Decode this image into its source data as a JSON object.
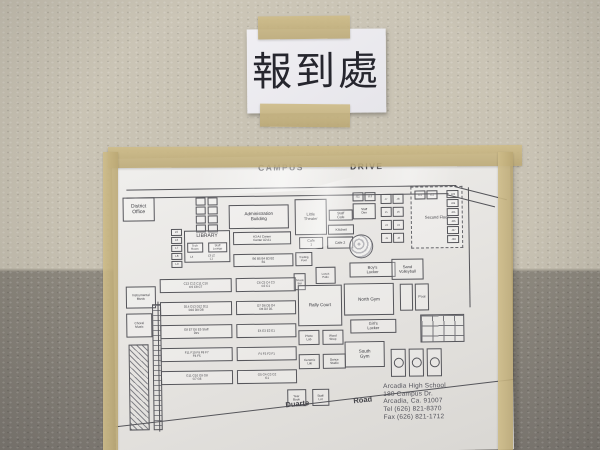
{
  "colors": {
    "wall_upper": "#c9c2b3",
    "wall_lower": "#86817a",
    "tape": "#c8b584",
    "sign_paper": "#ecebef",
    "map_paper": "#e7e5e2",
    "ink": "#3b3b40"
  },
  "sign": {
    "text": "報到處"
  },
  "map": {
    "school_info": [
      "Arcadia High School",
      "180 Campus Dr.",
      "Arcadia, Ca. 91007",
      "Tel (626) 821-8370",
      "Fax (626) 821-1712"
    ],
    "labels": [
      {
        "n": "street-label-campus",
        "t": "CAMPUS",
        "x": 146,
        "y": 6,
        "fs": 8.5,
        "ls": 1.5
      },
      {
        "n": "street-label-drive",
        "t": "DRIVE",
        "x": 238,
        "y": 6,
        "fs": 8.5,
        "ls": 1.5
      },
      {
        "n": "street-label-duarte",
        "t": "Duarte",
        "x": 170,
        "y": 243,
        "fs": 7.5,
        "deg": -5
      },
      {
        "n": "street-label-road",
        "t": "Road",
        "x": 238,
        "y": 240,
        "fs": 7.5,
        "deg": -5
      }
    ],
    "lines": [
      {
        "x": 14,
        "y": 31,
        "l": 330,
        "deg": 0
      },
      {
        "x": 14,
        "y": 39,
        "l": 322,
        "deg": 0
      },
      {
        "x": 342,
        "y": 32,
        "l": 54,
        "deg": 15
      },
      {
        "x": 334,
        "y": 40,
        "l": 50,
        "deg": 15
      },
      {
        "x": 356,
        "y": 33,
        "l": 120,
        "deg": 90
      },
      {
        "x": 44,
        "y": 143,
        "l": 130,
        "deg": 90
      },
      {
        "x": -4,
        "y": 268,
        "l": 416,
        "deg": -6
      }
    ],
    "buildings": [
      {
        "n": "district-office",
        "t": "District Office",
        "x": 10,
        "y": 39,
        "w": 32,
        "h": 24,
        "fs": 5
      },
      {
        "n": "portable-box",
        "t": "",
        "x": 83,
        "y": 40,
        "w": 10,
        "h": 8
      },
      {
        "n": "portable-box",
        "t": "",
        "x": 95,
        "y": 40,
        "w": 10,
        "h": 8
      },
      {
        "n": "portable-box",
        "t": "",
        "x": 83,
        "y": 49,
        "w": 10,
        "h": 8
      },
      {
        "n": "portable-box",
        "t": "",
        "x": 95,
        "y": 49,
        "w": 10,
        "h": 8
      },
      {
        "n": "portable-box",
        "t": "",
        "x": 83,
        "y": 58,
        "w": 10,
        "h": 8
      },
      {
        "n": "portable-box",
        "t": "",
        "x": 95,
        "y": 58,
        "w": 10,
        "h": 8
      },
      {
        "n": "portable-box",
        "t": "",
        "x": 83,
        "y": 67,
        "w": 10,
        "h": 8
      },
      {
        "n": "portable-box",
        "t": "",
        "x": 95,
        "y": 67,
        "w": 10,
        "h": 8
      },
      {
        "n": "administration-building",
        "t": "Administration Building",
        "x": 116,
        "y": 48,
        "w": 60,
        "h": 24,
        "fs": 4.5
      },
      {
        "n": "little-theater",
        "t": "Little Theater",
        "x": 182,
        "y": 43,
        "w": 32,
        "h": 36,
        "fs": 4
      },
      {
        "n": "staff-cafe",
        "t": "Staff Cafe",
        "x": 216,
        "y": 54,
        "w": 24,
        "h": 11,
        "fs": 3.5
      },
      {
        "n": "kitchen",
        "t": "Kitchen",
        "x": 215,
        "y": 69,
        "w": 26,
        "h": 10,
        "fs": 3.5
      },
      {
        "n": "cafe-1",
        "t": "Cafe 1",
        "x": 186,
        "y": 81,
        "w": 24,
        "h": 12,
        "fs": 3.5
      },
      {
        "n": "cafe-2",
        "t": "Cafe 2",
        "x": 214,
        "y": 81,
        "w": 26,
        "h": 12,
        "fs": 3.5
      },
      {
        "n": "library",
        "t": "LIBRARY",
        "x": 71,
        "y": 73,
        "w": 46,
        "h": 32,
        "fs": 5,
        "cls": "top"
      },
      {
        "n": "tech-room",
        "t": "Tech Room",
        "x": 74,
        "y": 85,
        "w": 16,
        "h": 10,
        "fs": 2.8
      },
      {
        "n": "staff-lounge",
        "t": "Staff Lounge",
        "x": 95,
        "y": 85,
        "w": 19,
        "h": 10,
        "fs": 2.8
      },
      {
        "n": "room-l4",
        "t": "L4",
        "x": 74,
        "y": 96,
        "w": 8,
        "h": 7,
        "fs": 2.8,
        "cls": "noborder"
      },
      {
        "n": "rooms-l3-l2-l1",
        "t": "L3  L2  L1",
        "x": 84,
        "y": 96,
        "w": 28,
        "h": 7,
        "fs": 2.8,
        "cls": "noborder"
      },
      {
        "n": "room-l5",
        "t": "L5",
        "x": 58,
        "y": 71,
        "w": 11,
        "h": 7,
        "fs": 2.8
      },
      {
        "n": "room-l6",
        "t": "L6",
        "x": 58,
        "y": 79,
        "w": 11,
        "h": 7,
        "fs": 2.8
      },
      {
        "n": "room-l7",
        "t": "L7",
        "x": 58,
        "y": 87,
        "w": 11,
        "h": 7,
        "fs": 2.8
      },
      {
        "n": "room-l8",
        "t": "L8",
        "x": 58,
        "y": 95,
        "w": 11,
        "h": 7,
        "fs": 2.8
      },
      {
        "n": "room-l9",
        "t": "L9",
        "x": 58,
        "y": 103,
        "w": 11,
        "h": 7,
        "fs": 2.8
      },
      {
        "n": "a-row",
        "t": "A3   A4   Career Center   A2   A1",
        "x": 120,
        "y": 75,
        "w": 58,
        "h": 13,
        "fs": 3
      },
      {
        "n": "b-row",
        "t": "B6  B5  B4  B3  B2  B1",
        "x": 120,
        "y": 97,
        "w": 60,
        "h": 13,
        "fs": 3
      },
      {
        "n": "trading-post",
        "t": "Trading Post",
        "x": 182,
        "y": 96,
        "w": 17,
        "h": 14,
        "fs": 2.8
      },
      {
        "n": "snack-bar",
        "t": "Snack Bar",
        "x": 180,
        "y": 117,
        "w": 12,
        "h": 17,
        "fs": 2.8
      },
      {
        "n": "lunch-patio",
        "t": "Lunch Patio",
        "x": 202,
        "y": 111,
        "w": 20,
        "h": 17,
        "fs": 2.8
      },
      {
        "n": "amphitheater",
        "t": "",
        "x": 236,
        "y": 79,
        "w": 24,
        "h": 24,
        "cls": "fan"
      },
      {
        "n": "c-row-west",
        "t": "C13 C12 C11 C10 C9 C8 C7",
        "x": 46,
        "y": 121,
        "w": 72,
        "h": 14,
        "fs": 3
      },
      {
        "n": "c-row-east",
        "t": "C6  C5  C4  C3  C2  C1",
        "x": 122,
        "y": 121,
        "w": 60,
        "h": 14,
        "fs": 3
      },
      {
        "n": "d-row-west",
        "t": "D14 D13 D12 D11 D10 D9 D8",
        "x": 46,
        "y": 144,
        "w": 72,
        "h": 14,
        "fs": 3
      },
      {
        "n": "d-row-east",
        "t": "D7  D6  D5  D4  D3  D2  D1",
        "x": 122,
        "y": 144,
        "w": 60,
        "h": 14,
        "fs": 3
      },
      {
        "n": "e-row-west",
        "t": "E8  E7  E6  E5  Staff Dev",
        "x": 46,
        "y": 167,
        "w": 72,
        "h": 14,
        "fs": 3
      },
      {
        "n": "e-row-east",
        "t": "E4   E3   E2   E1",
        "x": 122,
        "y": 167,
        "w": 60,
        "h": 14,
        "fs": 3
      },
      {
        "n": "f-row-west",
        "t": "F11 F10 F9 F8 F7 F6 F5",
        "x": 46,
        "y": 190,
        "w": 72,
        "h": 14,
        "fs": 3
      },
      {
        "n": "f-row-east",
        "t": "F4   F3   F2   F1",
        "x": 122,
        "y": 190,
        "w": 60,
        "h": 14,
        "fs": 3
      },
      {
        "n": "g-row-west",
        "t": "G11 G10 G9 G8 G7 G6",
        "x": 46,
        "y": 213,
        "w": 72,
        "h": 14,
        "fs": 3
      },
      {
        "n": "g-row-east",
        "t": "G5  G4  G3  G2  G1",
        "x": 122,
        "y": 213,
        "w": 60,
        "h": 14,
        "fs": 3
      },
      {
        "n": "instrumental-music",
        "t": "Instrumental Music",
        "x": 12,
        "y": 128,
        "w": 30,
        "h": 22,
        "fs": 3.2
      },
      {
        "n": "choral-music",
        "t": "Choral Music",
        "x": 12,
        "y": 155,
        "w": 26,
        "h": 24,
        "fs": 3.2
      },
      {
        "n": "parking-lot",
        "t": "",
        "x": 14,
        "y": 186,
        "w": 20,
        "h": 86,
        "cls": "hatch"
      },
      {
        "n": "parking-stalls",
        "t": "",
        "x": 38,
        "y": 146,
        "w": 9,
        "h": 126,
        "cls": "rows"
      },
      {
        "n": "year-book",
        "t": "Year Book",
        "x": 172,
        "y": 233,
        "w": 19,
        "h": 17,
        "fs": 3
      },
      {
        "n": "staff-lot",
        "t": "Staff Lot",
        "x": 197,
        "y": 233,
        "w": 17,
        "h": 17,
        "fs": 3
      },
      {
        "n": "boys-locker",
        "t": "Boy's Locker",
        "x": 236,
        "y": 107,
        "w": 46,
        "h": 15,
        "fs": 4
      },
      {
        "n": "sand-volleyball",
        "t": "Sand Volleyball",
        "x": 278,
        "y": 104,
        "w": 32,
        "h": 21,
        "fs": 4
      },
      {
        "n": "north-gym",
        "t": "North Gym",
        "x": 230,
        "y": 128,
        "w": 50,
        "h": 32,
        "fs": 4.5
      },
      {
        "n": "pool-west",
        "t": "",
        "x": 286,
        "y": 129,
        "w": 13,
        "h": 27
      },
      {
        "n": "pool",
        "t": "Pool",
        "x": 301,
        "y": 129,
        "w": 14,
        "h": 27,
        "fs": 3.5
      },
      {
        "n": "rally-court",
        "t": "Rally Court",
        "x": 184,
        "y": 129,
        "w": 44,
        "h": 41,
        "fs": 4.5
      },
      {
        "n": "girls-locker",
        "t": "Girl's Locker",
        "x": 236,
        "y": 164,
        "w": 46,
        "h": 14,
        "fs": 4
      },
      {
        "n": "photo-lab",
        "t": "Photo Lab",
        "x": 184,
        "y": 174,
        "w": 21,
        "h": 15,
        "fs": 3
      },
      {
        "n": "wood-shop",
        "t": "Wood Shop",
        "x": 208,
        "y": 174,
        "w": 21,
        "h": 15,
        "fs": 3
      },
      {
        "n": "south-gym",
        "t": "South Gym",
        "x": 230,
        "y": 186,
        "w": 40,
        "h": 26,
        "fs": 4.5
      },
      {
        "n": "ceramic-lab",
        "t": "Ceramic Lab",
        "x": 184,
        "y": 198,
        "w": 21,
        "h": 15,
        "fs": 3
      },
      {
        "n": "dance-studio",
        "t": "Dance Studio",
        "x": 208,
        "y": 198,
        "w": 23,
        "h": 15,
        "fs": 3
      },
      {
        "n": "tennis-courts",
        "t": "",
        "x": 306,
        "y": 160,
        "w": 44,
        "h": 28,
        "cls": "grid"
      },
      {
        "n": "basketball-court",
        "t": "",
        "x": 276,
        "y": 194,
        "w": 15,
        "h": 28,
        "cls": "court"
      },
      {
        "n": "basketball-court",
        "t": "",
        "x": 294,
        "y": 194,
        "w": 15,
        "h": 28,
        "cls": "court"
      },
      {
        "n": "basketball-court",
        "t": "",
        "x": 312,
        "y": 194,
        "w": 15,
        "h": 28,
        "cls": "court"
      },
      {
        "n": "second-floor-block",
        "t": "Second Floor",
        "x": 298,
        "y": 32,
        "w": 52,
        "h": 62,
        "fs": 4,
        "cls": "dashed"
      },
      {
        "n": "room-j21",
        "t": "J21",
        "x": 302,
        "y": 36,
        "w": 11,
        "h": 9,
        "fs": 2.6
      },
      {
        "n": "room-j22",
        "t": "J22",
        "x": 314,
        "y": 36,
        "w": 11,
        "h": 9,
        "fs": 2.6
      },
      {
        "n": "room-j23",
        "t": "J23",
        "x": 334,
        "y": 36,
        "w": 12,
        "h": 8,
        "fs": 2.6
      },
      {
        "n": "room-j24",
        "t": "J24",
        "x": 334,
        "y": 45,
        "w": 12,
        "h": 8,
        "fs": 2.6
      },
      {
        "n": "room-j25",
        "t": "J25",
        "x": 334,
        "y": 54,
        "w": 12,
        "h": 8,
        "fs": 2.6
      },
      {
        "n": "room-j26",
        "t": "J26",
        "x": 334,
        "y": 63,
        "w": 12,
        "h": 8,
        "fs": 2.6
      },
      {
        "n": "room-j27",
        "t": "J27",
        "x": 334,
        "y": 72,
        "w": 12,
        "h": 8,
        "fs": 2.6
      },
      {
        "n": "room-j28",
        "t": "J28",
        "x": 334,
        "y": 81,
        "w": 12,
        "h": 8,
        "fs": 2.6
      },
      {
        "n": "room-j11",
        "t": "J11",
        "x": 240,
        "y": 37,
        "w": 11,
        "h": 9,
        "fs": 2.6
      },
      {
        "n": "room-j12",
        "t": "J12",
        "x": 252,
        "y": 37,
        "w": 11,
        "h": 9,
        "fs": 2.6
      },
      {
        "n": "staff-den",
        "t": "Staff Den",
        "x": 240,
        "y": 48,
        "w": 23,
        "h": 16,
        "fs": 3
      },
      {
        "n": "room-j7",
        "t": "J7",
        "x": 268,
        "y": 39,
        "w": 11,
        "h": 10,
        "fs": 2.6
      },
      {
        "n": "room-j8",
        "t": "J8",
        "x": 280,
        "y": 39,
        "w": 11,
        "h": 10,
        "fs": 2.6
      },
      {
        "n": "room-j5",
        "t": "J5",
        "x": 268,
        "y": 52,
        "w": 11,
        "h": 10,
        "fs": 2.6
      },
      {
        "n": "room-j6",
        "t": "J6",
        "x": 280,
        "y": 52,
        "w": 11,
        "h": 10,
        "fs": 2.6
      },
      {
        "n": "room-j3",
        "t": "J3",
        "x": 268,
        "y": 65,
        "w": 11,
        "h": 10,
        "fs": 2.6
      },
      {
        "n": "room-j4",
        "t": "J4",
        "x": 280,
        "y": 65,
        "w": 11,
        "h": 10,
        "fs": 2.6
      },
      {
        "n": "room-j1",
        "t": "J1",
        "x": 268,
        "y": 78,
        "w": 11,
        "h": 10,
        "fs": 2.6
      },
      {
        "n": "room-j2",
        "t": "J2",
        "x": 280,
        "y": 78,
        "w": 11,
        "h": 10,
        "fs": 2.6
      }
    ]
  }
}
